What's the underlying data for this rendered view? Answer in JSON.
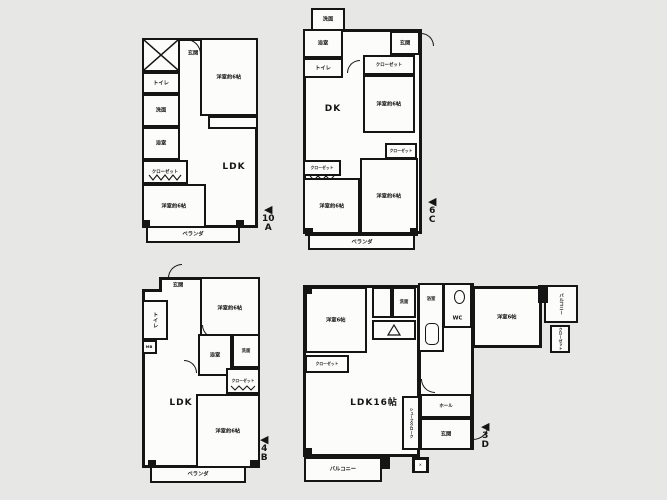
{
  "page": {
    "background_color": "#e7e7e5",
    "wall_color": "#151515"
  },
  "plans": {
    "a": {
      "marker": {
        "arrow": "◀",
        "floor": "10",
        "unit": "A"
      },
      "rooms": {
        "genkan": "玄関",
        "toilet": "トイレ",
        "washroom": "洗面",
        "bath": "浴室",
        "closet": "クローゼット",
        "bedroom_top": "洋室約6帖",
        "bedroom_bottom": "洋室約6帖",
        "ldk": "LDK",
        "veranda": "ベランダ"
      }
    },
    "b": {
      "marker": {
        "arrow": "◀",
        "floor": "4",
        "unit": "B"
      },
      "rooms": {
        "genkan": "玄関",
        "toilet": "トイレ",
        "mb": "MB",
        "bedroom_top": "洋室約6帖",
        "bath": "浴室",
        "washroom": "洗面",
        "closet": "クローゼット",
        "ldk": "LDK",
        "bedroom_bottom": "洋室約6帖",
        "veranda": "ベランダ"
      }
    },
    "c": {
      "marker": {
        "arrow": "◀",
        "floor": "6",
        "unit": "C"
      },
      "rooms": {
        "washroom": "洗面",
        "bath": "浴室",
        "toilet": "トイレ",
        "genkan": "玄関",
        "closet_top": "クローゼット",
        "bedroom_mid": "洋室約6帖",
        "dk": "DK",
        "closet_mid": "クローゼット",
        "closet_left": "クローゼット",
        "bedroom_bottom_left": "洋室約6帖",
        "bedroom_bottom_right": "洋室約6帖",
        "veranda": "ベランダ"
      }
    },
    "d": {
      "marker": {
        "arrow": "◀",
        "floor": "3",
        "unit": "D"
      },
      "rooms": {
        "bedroom_left": "洋室6帖",
        "closet_left": "クローゼット",
        "washbasin": "洗面",
        "bath": "浴室",
        "wc": "WC",
        "bedroom_right": "洋室6帖",
        "balcony_side": "バルコニー",
        "closet_right": "クローゼット",
        "ldk": "LDK16帖",
        "shoes_closet": "シューズクローク",
        "hall": "ホール",
        "genkan": "玄関",
        "mb": "✕",
        "balcony_bottom": "バルコニー"
      }
    }
  }
}
